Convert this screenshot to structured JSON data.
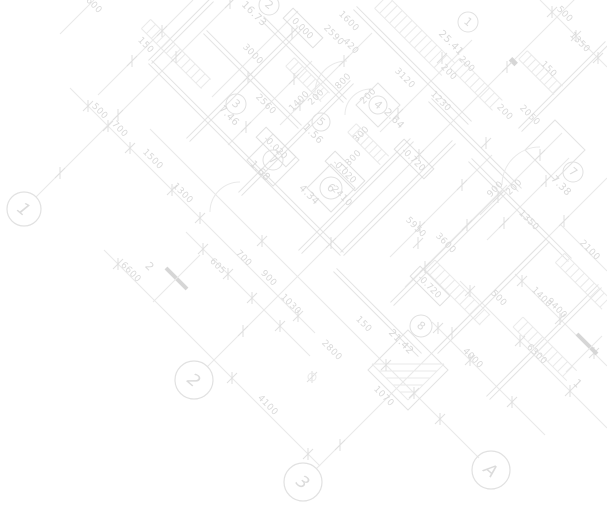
{
  "drawing": {
    "kind": "architectural-floor-plan",
    "background": "#ffffff",
    "colors": {
      "line": "#e9e9e9",
      "wall": "#e3e3e3",
      "hatch": "#eaeaea",
      "tick": "#dfdfdf",
      "text": "#d9d9d9",
      "circle_stroke": "#e1e1e1",
      "circle_text": "#dbdbdb",
      "elev_stroke": "#e0e0e0",
      "thick": "#d6d6d6"
    }
  },
  "grid_markers": [
    {
      "label": "1",
      "x": 24,
      "y": 209,
      "r": 17
    },
    {
      "label": "2",
      "x": 194,
      "y": 380,
      "r": 19
    },
    {
      "label": "3",
      "x": 303,
      "y": 482,
      "r": 19
    },
    {
      "label": "A",
      "x": 491,
      "y": 470,
      "r": 19
    }
  ],
  "room_markers": [
    {
      "label": "1",
      "area": "25.41",
      "cx": 468,
      "cy": 22,
      "r": 10,
      "tx": 449,
      "ty": 45,
      "rot": 45
    },
    {
      "label": "2",
      "area": "16.73",
      "cx": 269,
      "cy": 5,
      "r": 10,
      "tx": 252,
      "ty": 16,
      "rot": 45
    },
    {
      "label": "3",
      "area": "7.46",
      "cx": 236,
      "cy": 104,
      "r": 10,
      "tx": 227,
      "ty": 118,
      "rot": 45
    },
    {
      "label": "4",
      "area": "2.64",
      "cx": 378,
      "cy": 105,
      "r": 9,
      "tx": 392,
      "ty": 121,
      "rot": 45
    },
    {
      "label": "5",
      "area": "1.56",
      "cx": 321,
      "cy": 122,
      "r": 9,
      "tx": 311,
      "ty": 136,
      "rot": 45
    },
    {
      "label": "6",
      "area": "4.34",
      "cx": 331,
      "cy": 188,
      "r": 11,
      "tx": 307,
      "ty": 197,
      "rot": 45
    },
    {
      "label": "7",
      "area": "1.68",
      "cx": 273,
      "cy": 160,
      "r": 10,
      "tx": 258,
      "ty": 173,
      "rot": 45
    },
    {
      "label": "7",
      "area": "7.38",
      "cx": 573,
      "cy": 172,
      "r": 10,
      "tx": 559,
      "ty": 188,
      "rot": 45
    },
    {
      "label": "8",
      "area": "21.42",
      "cx": 421,
      "cy": 326,
      "r": 11,
      "tx": 399,
      "ty": 344,
      "rot": 45
    }
  ],
  "elevation_marks": [
    {
      "value": "0.000",
      "x": 303,
      "y": 28,
      "rot": 45
    },
    {
      "value": "-0.020",
      "x": 276,
      "y": 147,
      "rot": 45
    },
    {
      "value": "-0.020",
      "x": 345,
      "y": 171,
      "rot": 45
    },
    {
      "value": "-0.720",
      "x": 414,
      "y": 159,
      "rot": 45
    },
    {
      "value": "-0.720",
      "x": 430,
      "y": 286,
      "rot": 45
    }
  ],
  "section_markers": [
    {
      "label": "2",
      "x": 147,
      "y": 269,
      "lx1": 166,
      "ly1": 268,
      "lx2": 187,
      "ly2": 289,
      "tx1": 153,
      "ty1": 302,
      "tx2": 200,
      "ty2": 255
    },
    {
      "label": "1",
      "x": 575,
      "y": 386,
      "lx1": 577,
      "ly1": 334,
      "lx2": 597,
      "ly2": 354,
      "tx1": 566,
      "ty1": 372,
      "tx2": 602,
      "ty2": 336
    }
  ],
  "dimensions": [
    {
      "text": "2600",
      "x": 90,
      "y": 5,
      "rot": 45
    },
    {
      "text": "150",
      "x": 144,
      "y": 47,
      "rot": 45
    },
    {
      "text": "500",
      "x": 98,
      "y": 113,
      "rot": 45
    },
    {
      "text": "700",
      "x": 118,
      "y": 131,
      "rot": 45
    },
    {
      "text": "1500",
      "x": 151,
      "y": 161,
      "rot": 45
    },
    {
      "text": "1300",
      "x": 181,
      "y": 195,
      "rot": 45
    },
    {
      "text": "3000",
      "x": 251,
      "y": 56,
      "rot": 45
    },
    {
      "text": "2560",
      "x": 264,
      "y": 106,
      "rot": 45
    },
    {
      "text": "1600",
      "x": 347,
      "y": 23,
      "rot": 45
    },
    {
      "text": "2590",
      "x": 332,
      "y": 37,
      "rot": 45
    },
    {
      "text": "420",
      "x": 349,
      "y": 48,
      "rot": 45
    },
    {
      "text": "800",
      "x": 345,
      "y": 83,
      "rot": -45
    },
    {
      "text": "200",
      "x": 318,
      "y": 99,
      "rot": -45
    },
    {
      "text": "1400",
      "x": 301,
      "y": 103,
      "rot": -45
    },
    {
      "text": "200",
      "x": 370,
      "y": 98,
      "rot": -45
    },
    {
      "text": "300",
      "x": 363,
      "y": 136,
      "rot": -45
    },
    {
      "text": "1800",
      "x": 353,
      "y": 162,
      "rot": -45
    },
    {
      "text": "2410",
      "x": 340,
      "y": 198,
      "rot": 45
    },
    {
      "text": "3120",
      "x": 403,
      "y": 80,
      "rot": 45
    },
    {
      "text": "200",
      "x": 447,
      "y": 74,
      "rot": 45
    },
    {
      "text": "1230",
      "x": 439,
      "y": 103,
      "rot": 45
    },
    {
      "text": "200",
      "x": 465,
      "y": 66,
      "rot": 45
    },
    {
      "text": "500",
      "x": 563,
      "y": 16,
      "rot": 45
    },
    {
      "text": "1350",
      "x": 578,
      "y": 44,
      "rot": 45
    },
    {
      "text": "150",
      "x": 547,
      "y": 71,
      "rot": 45
    },
    {
      "text": "2050",
      "x": 528,
      "y": 117,
      "rot": 45
    },
    {
      "text": "200",
      "x": 503,
      "y": 114,
      "rot": 45
    },
    {
      "text": "900",
      "x": 497,
      "y": 191,
      "rot": -45
    },
    {
      "text": "200",
      "x": 516,
      "y": 189,
      "rot": -45
    },
    {
      "text": "1350",
      "x": 527,
      "y": 222,
      "rot": 45
    },
    {
      "text": "5950",
      "x": 414,
      "y": 229,
      "rot": 45
    },
    {
      "text": "3600",
      "x": 444,
      "y": 245,
      "rot": 45
    },
    {
      "text": "6600",
      "x": 129,
      "y": 274,
      "rot": 45
    },
    {
      "text": "605",
      "x": 216,
      "y": 268,
      "rot": 45
    },
    {
      "text": "700",
      "x": 242,
      "y": 260,
      "rot": 45
    },
    {
      "text": "900",
      "x": 267,
      "y": 280,
      "rot": 45
    },
    {
      "text": "1030",
      "x": 289,
      "y": 306,
      "rot": 45
    },
    {
      "text": "4100",
      "x": 266,
      "y": 407,
      "rot": 45
    },
    {
      "text": "150",
      "x": 362,
      "y": 326,
      "rot": 45
    },
    {
      "text": "2800",
      "x": 330,
      "y": 352,
      "rot": 45
    },
    {
      "text": "1070",
      "x": 382,
      "y": 398,
      "rot": 45
    },
    {
      "text": "4000",
      "x": 471,
      "y": 360,
      "rot": 45
    },
    {
      "text": "6300",
      "x": 535,
      "y": 356,
      "rot": 45
    },
    {
      "text": "500",
      "x": 497,
      "y": 300,
      "rot": 45
    },
    {
      "text": "1400",
      "x": 540,
      "y": 299,
      "rot": 45
    },
    {
      "text": "9400",
      "x": 555,
      "y": 310,
      "rot": 45
    },
    {
      "text": "2100",
      "x": 588,
      "y": 252,
      "rot": 45
    }
  ]
}
